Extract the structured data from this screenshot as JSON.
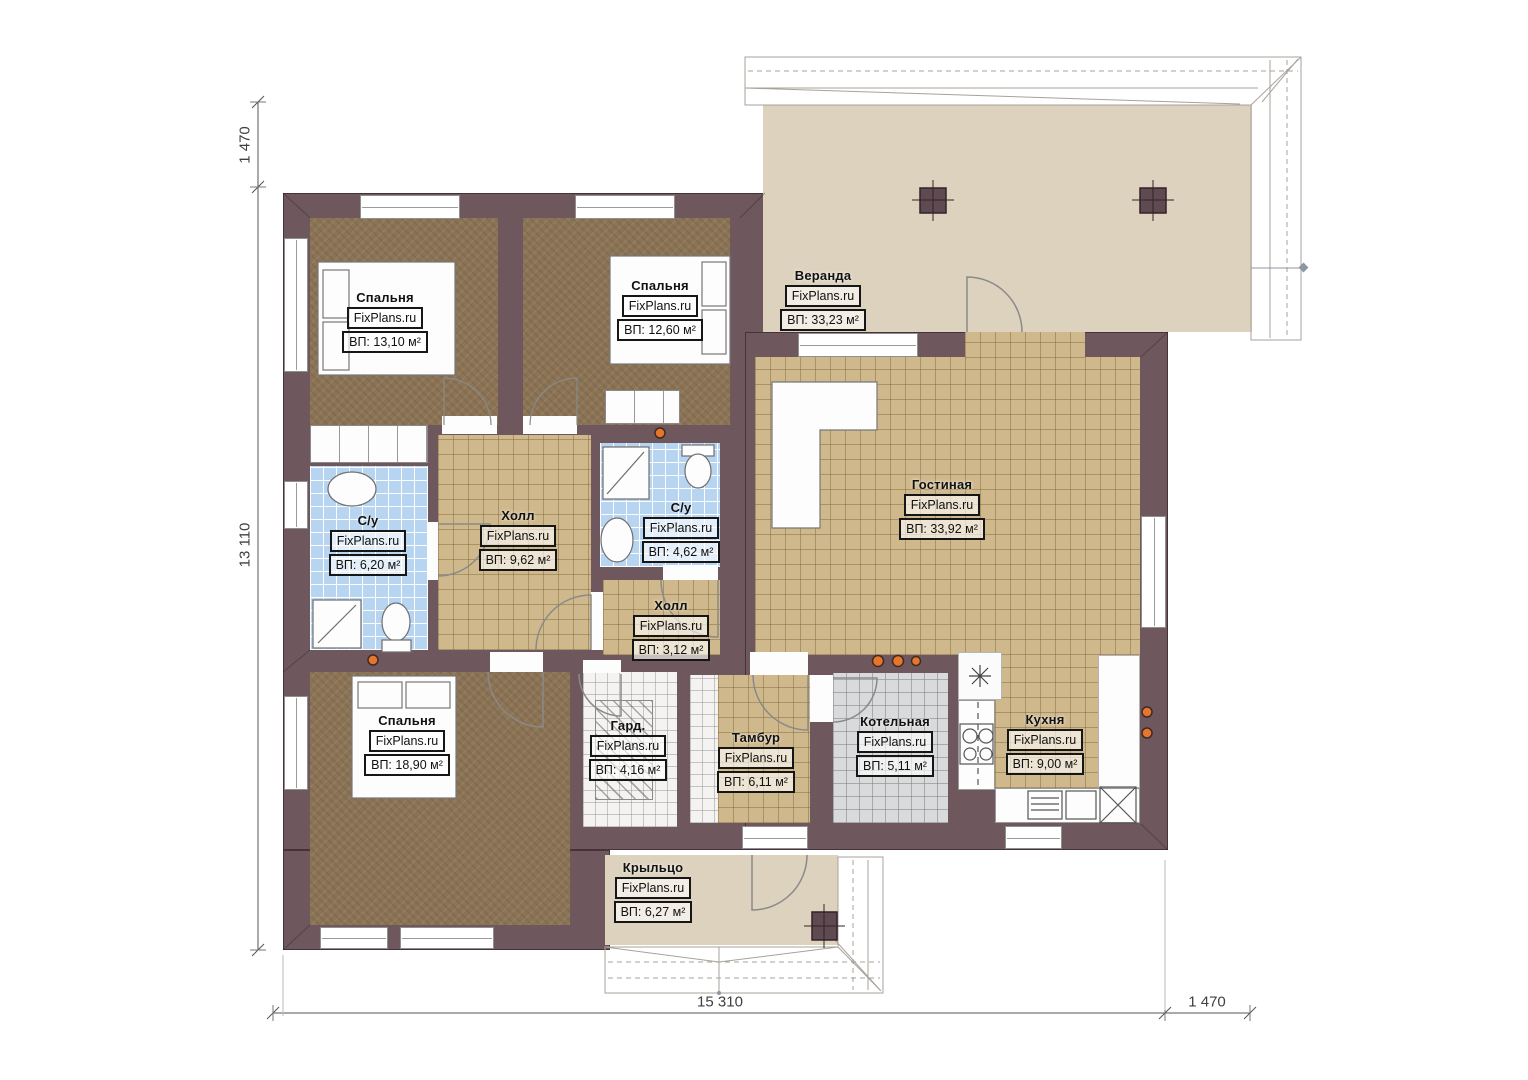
{
  "brand": "FixPlans.ru",
  "rooms": {
    "bedroom1": {
      "name": "Спальня",
      "area": "ВП: 13,10 м²"
    },
    "bedroom2": {
      "name": "Спальня",
      "area": "ВП: 12,60 м²"
    },
    "veranda": {
      "name": "Веранда",
      "area": "ВП: 33,23 м²"
    },
    "living": {
      "name": "Гостиная",
      "area": "ВП: 33,92 м²"
    },
    "bath1": {
      "name": "С/у",
      "area": "ВП: 6,20 м²"
    },
    "hall1": {
      "name": "Холл",
      "area": "ВП: 9,62 м²"
    },
    "bath2": {
      "name": "С/у",
      "area": "ВП: 4,62 м²"
    },
    "hall2": {
      "name": "Холл",
      "area": "ВП: 3,12 м²"
    },
    "bedroom3": {
      "name": "Спальня",
      "area": "ВП: 18,90 м²"
    },
    "wardrobe": {
      "name": "Гард.",
      "area": "ВП: 4,16 м²"
    },
    "vestibule": {
      "name": "Тамбур",
      "area": "ВП: 6,11 м²"
    },
    "boiler": {
      "name": "Котельная",
      "area": "ВП: 5,11 м²"
    },
    "kitchen": {
      "name": "Кухня",
      "area": "ВП: 9,00 м²"
    },
    "porch": {
      "name": "Крыльцо",
      "area": "ВП: 6,27 м²"
    }
  },
  "dimensions": {
    "left_offset": "1 470",
    "left_total": "13 110",
    "bottom_total": "15 310",
    "bottom_offset": "1 470"
  },
  "colors": {
    "wall": "#6e575d",
    "walledge": "#45333a",
    "carpet": "#8b7355",
    "tilebeige": "#cfb88c",
    "tileblue": "#b7d4f0",
    "tilegray": "#d9dadb",
    "tilewhite": "#f4f3f1",
    "terrace": "#ddd2be",
    "vent": "#e8752c"
  }
}
